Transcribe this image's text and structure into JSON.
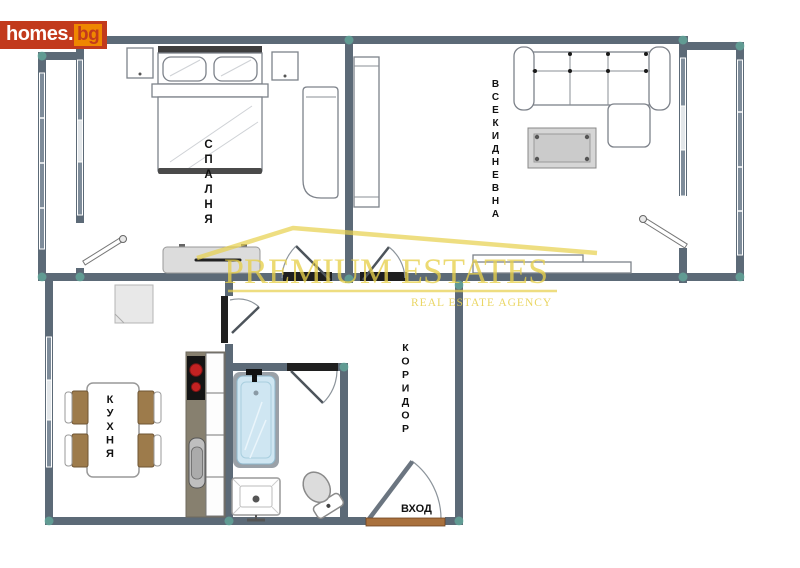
{
  "logo": {
    "main": "homes.",
    "suffix": "bg"
  },
  "watermark": {
    "title": "PREMIUM ESTATES",
    "subtitle": "REAL ESTATE AGENCY"
  },
  "rooms": {
    "bedroom": {
      "label": "СПАЛНЯ"
    },
    "living_room": {
      "label": "ВСЕКИДНЕВНА"
    },
    "kitchen": {
      "label": "КУХНЯ"
    },
    "corridor": {
      "label": "КОРИДОР"
    },
    "entrance": {
      "label": "ВХОД"
    }
  },
  "colors": {
    "wall": "#5c6a77",
    "window": "#7e8c9a",
    "window_light": "#e3e7ea",
    "accent_teal": "#66c2ab",
    "logo_red": "#c23a1c",
    "logo_orange": "#ef8700",
    "watermark_yellow": "#e7d04b",
    "counter": "#87806f",
    "cooktop": "#141414",
    "burner_red": "#c32222",
    "chair_brown": "#9d7b4b",
    "tub_blue": "#cfe6f2",
    "threshold_brown": "#a9713d",
    "furniture_gray": "#dcdcdc"
  }
}
